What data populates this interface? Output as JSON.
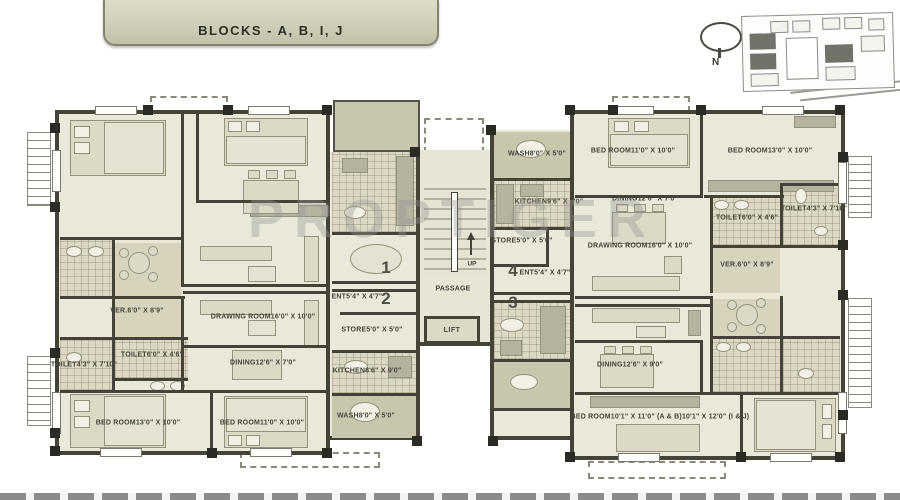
{
  "banner": {
    "title": "BLOCKS - A, B, I, J"
  },
  "compass": {
    "north": "N"
  },
  "watermark": {
    "text": "PROPTIGER"
  },
  "core": {
    "up": "UP",
    "passage": "PASSAGE",
    "lift": "LIFT"
  },
  "units": {
    "u1": "1",
    "u2": "2",
    "u3": "3",
    "u4": "4"
  },
  "labels": {
    "l_ver": {
      "name": "VER.",
      "dims": "6'0\" X 8'9\""
    },
    "l_drawing": {
      "name": "DRAWING ROOM",
      "dims": "16'0\" X 10'0\""
    },
    "l_toilet_small": {
      "name": "TOILET",
      "dims": "6'0\" X 4'6\""
    },
    "l_toilet_long": {
      "name": "TOILET",
      "dims": "4'3\" X 7'10\""
    },
    "l_dining": {
      "name": "DINING",
      "dims": "12'6\" X 7'0\""
    },
    "l_store": {
      "name": "STORE",
      "dims": "5'0\" X 5'0\""
    },
    "l_kitchen": {
      "name": "KITCHEN",
      "dims": "8'6\" X 9'0\""
    },
    "l_wash": {
      "name": "WASH",
      "dims": "8'0\" X 5'0\""
    },
    "l_ent": {
      "name": "ENT",
      "dims": "5'4\" X 4'7\""
    },
    "l_bed1": {
      "name": "BED ROOM",
      "dims": "13'0\" X 10'0\""
    },
    "l_bed2": {
      "name": "BED ROOM",
      "dims": "11'0\" X 10'0\""
    },
    "r4_wash": {
      "name": "WASH",
      "dims": "8'0\" X 5'0\""
    },
    "r4_bed1": {
      "name": "BED ROOM",
      "dims": "11'0\" X 10'0\""
    },
    "r4_bed2": {
      "name": "BED ROOM",
      "dims": "13'0\" X 10'0\""
    },
    "r4_kitchen": {
      "name": "KITCHEN",
      "dims": "9'6\" X 9'0\""
    },
    "r4_dining": {
      "name": "DINING",
      "dims": "12'6\" X 7'0\""
    },
    "r4_store": {
      "name": "STORE",
      "dims": "5'0\" X 5'0\""
    },
    "r4_drawing": {
      "name": "DRAWING ROOM",
      "dims": "16'0\" X 10'0\""
    },
    "r4_toilet_small": {
      "name": "TOILET",
      "dims": "6'0\" X 4'6\""
    },
    "r4_toilet_long": {
      "name": "TOILET",
      "dims": "4'3\" X 7'10\""
    },
    "r4_ent": {
      "name": "ENT",
      "dims": "5'4\" X 4'7\""
    },
    "r4_ver": {
      "name": "VER.",
      "dims": "6'0\" X 8'9\""
    },
    "r3_dining": {
      "name": "DINING",
      "dims": "12'6\" X 9'0\""
    },
    "r3_bed": {
      "name": "BED ROOM",
      "dims": "10'1\" X 11'0\" (A & B)",
      "dims2": "10'1\" X 12'0\" (I & J)"
    }
  }
}
